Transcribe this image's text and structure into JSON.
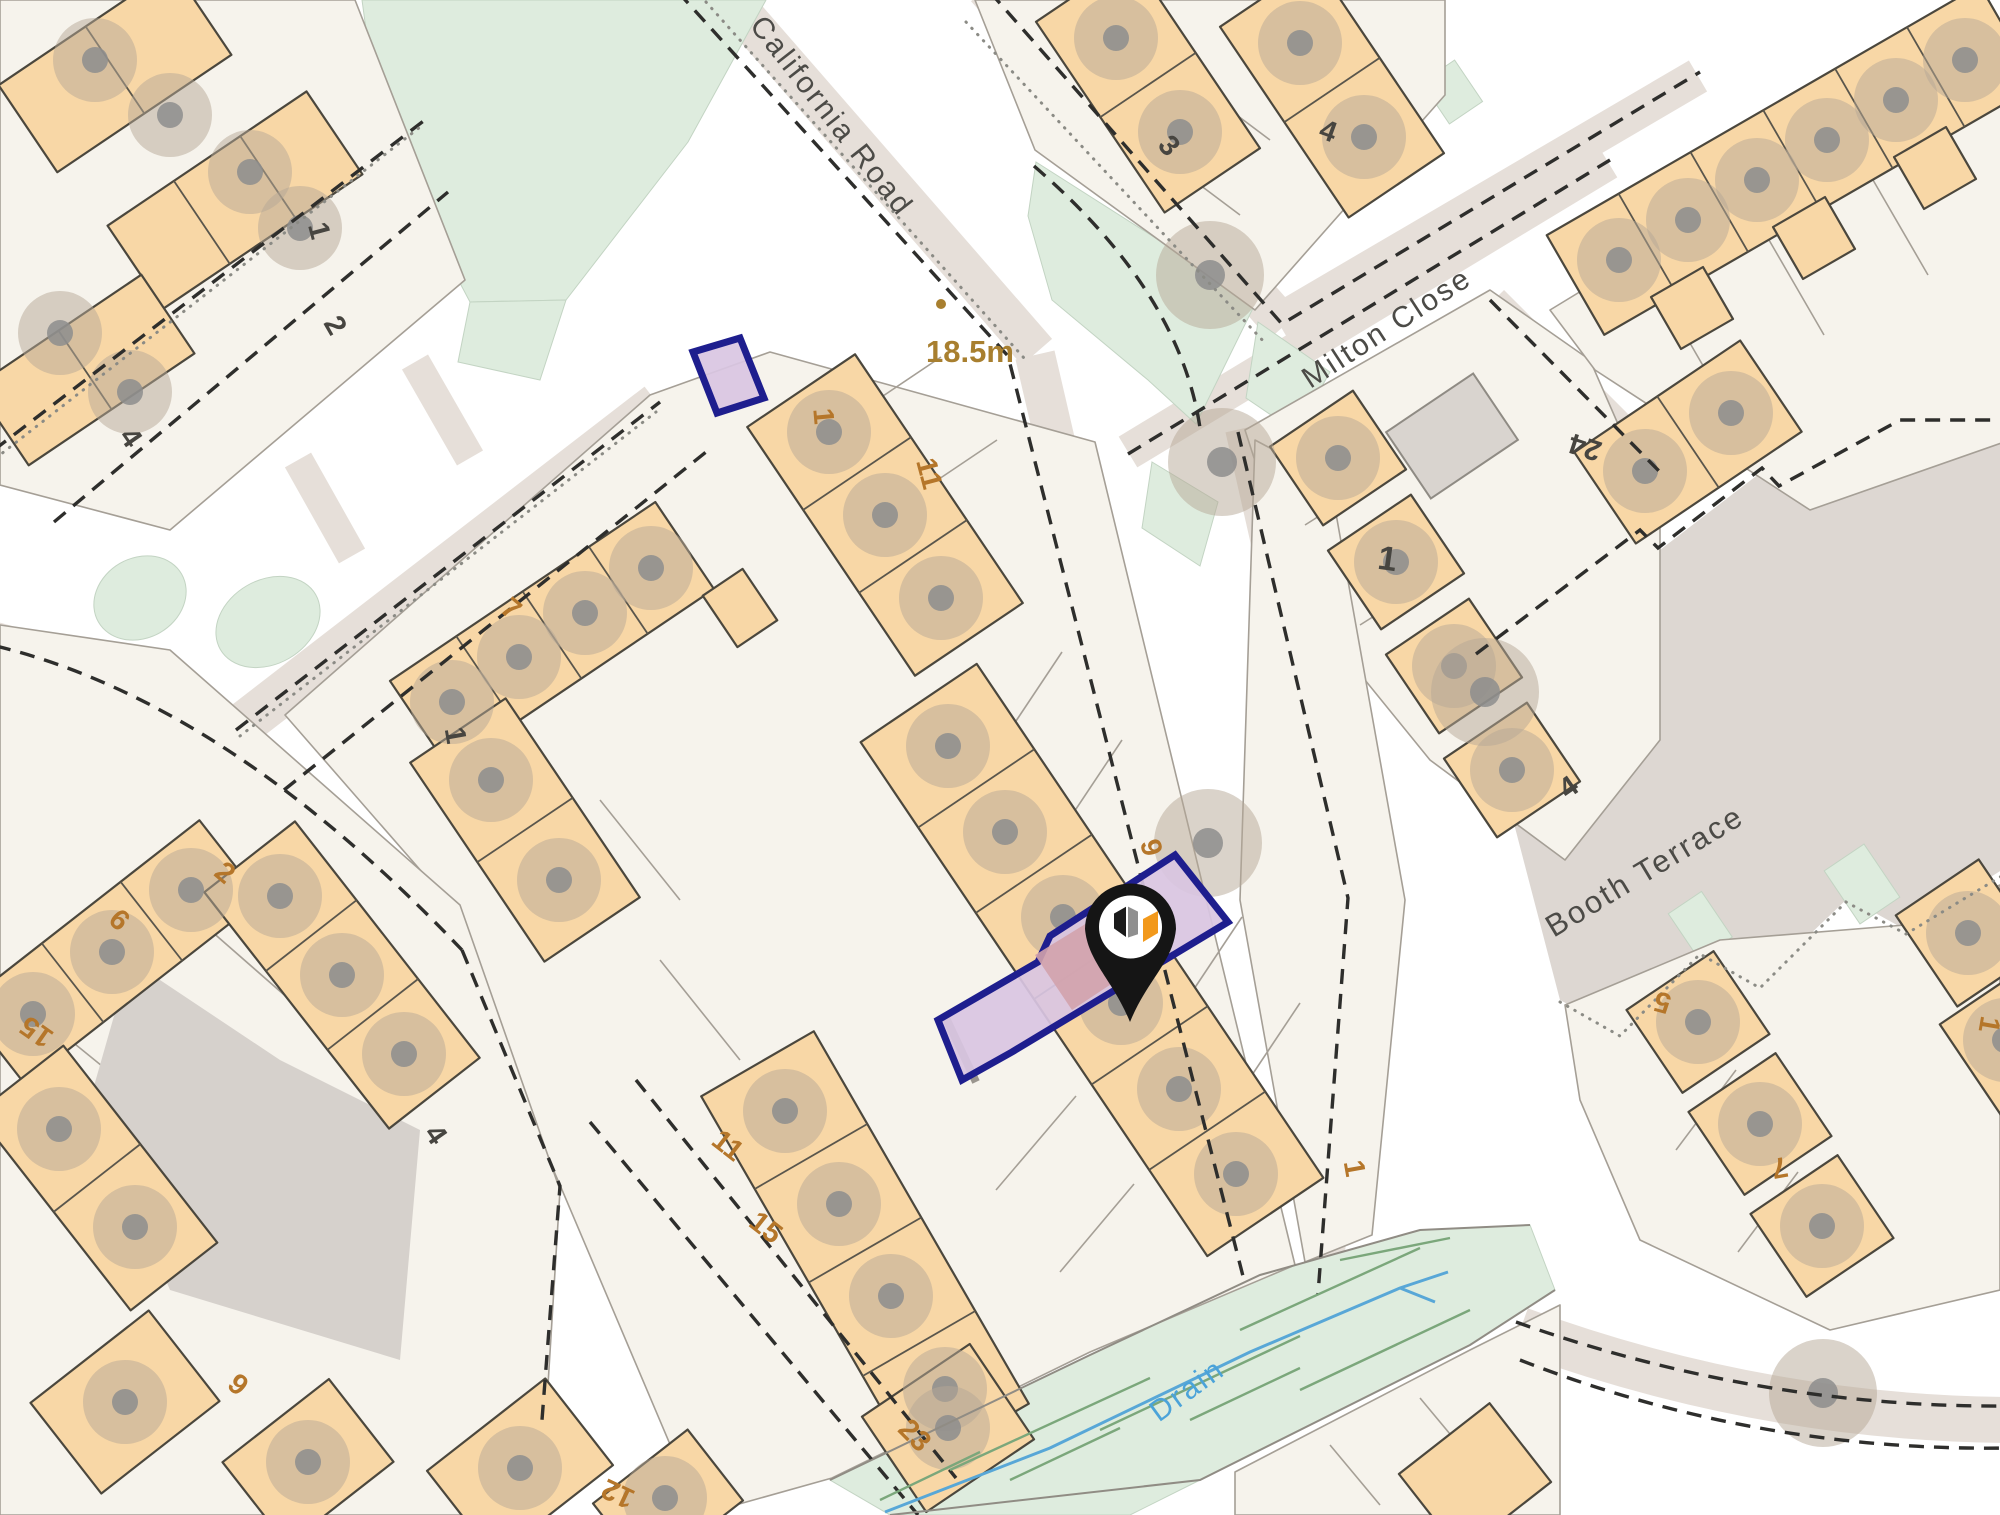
{
  "map": {
    "colors": {
      "building_fill": "#f8d7a6",
      "building_outline": "#4b473d",
      "parcel_fill": "#f6f3ec",
      "road_band": "#e6dfd9",
      "booth_terrace_surface": "#ddd7d2",
      "green_space": "#deecde",
      "boundary_dash": "#2e2e2c",
      "selection_fill": "#d9c5e2",
      "selection_stroke": "#1e1e8e",
      "building_in_selection": "#d2a2ac",
      "drain_blue": "#58a7d7",
      "house_number_orange": "#b5762a",
      "house_number_dark": "#474540",
      "street_label": "#4c4b47",
      "measurement": "#a87f2f",
      "pin_body": "#151515",
      "pin_accent_orange": "#f2991c"
    },
    "street_labels": [
      {
        "id": "california-road",
        "text": "California Road",
        "x": 824,
        "y": 122,
        "rot": 52,
        "size": 30,
        "tone": "road"
      },
      {
        "id": "milton-close",
        "text": "Milton Close",
        "x": 1392,
        "y": 336,
        "rot": -33,
        "size": 30,
        "tone": "road"
      },
      {
        "id": "booth-terrace",
        "text": "Booth Terrace",
        "x": 1650,
        "y": 880,
        "rot": -31,
        "size": 31,
        "tone": "road"
      },
      {
        "id": "drain",
        "text": "Drain",
        "x": 1193,
        "y": 1398,
        "rot": -36,
        "size": 30,
        "tone": "water"
      }
    ],
    "measurement": {
      "text": "18.5m",
      "x": 970,
      "y": 362,
      "dot": {
        "x": 941,
        "y": 304,
        "r": 5
      }
    },
    "marker": {
      "type": "property-pin",
      "x": 1130,
      "y": 935
    },
    "house_numbers": [
      {
        "text": "1",
        "x": 310,
        "y": 233,
        "rot": 75,
        "tone": "dark"
      },
      {
        "text": "2",
        "x": 327,
        "y": 330,
        "rot": 60,
        "tone": "dark"
      },
      {
        "text": "4",
        "x": 123,
        "y": 443,
        "rot": 55,
        "tone": "dark"
      },
      {
        "text": "3",
        "x": 1162,
        "y": 152,
        "rot": 48,
        "tone": "dark"
      },
      {
        "text": "4",
        "x": 1325,
        "y": 140,
        "rot": 20,
        "tone": "dark"
      },
      {
        "text": "24",
        "x": 1588,
        "y": 438,
        "rot": 198,
        "tone": "dark"
      },
      {
        "text": "1",
        "x": 1386,
        "y": 570,
        "rot": 8,
        "tone": "dark",
        "bold": true
      },
      {
        "text": "4",
        "x": 1574,
        "y": 795,
        "rot": -35,
        "tone": "dark"
      },
      {
        "text": "1",
        "x": 446,
        "y": 737,
        "rot": 80,
        "tone": "dark"
      },
      {
        "text": "4",
        "x": 428,
        "y": 1140,
        "rot": 55,
        "tone": "dark"
      },
      {
        "text": "7",
        "x": 505,
        "y": 616,
        "rot": 40,
        "tone": "orange"
      },
      {
        "text": "1",
        "x": 814,
        "y": 417,
        "rot": 85,
        "tone": "orange"
      },
      {
        "text": "11",
        "x": 920,
        "y": 476,
        "rot": 75,
        "tone": "orange"
      },
      {
        "text": "9",
        "x": 1142,
        "y": 850,
        "rot": 75,
        "tone": "orange"
      },
      {
        "text": "1",
        "x": 1345,
        "y": 1170,
        "rot": 80,
        "tone": "orange"
      },
      {
        "text": "11",
        "x": 722,
        "y": 1153,
        "rot": 38,
        "tone": "orange"
      },
      {
        "text": "15",
        "x": 760,
        "y": 1235,
        "rot": 38,
        "tone": "orange"
      },
      {
        "text": "23",
        "x": 908,
        "y": 1442,
        "rot": 45,
        "tone": "orange"
      },
      {
        "text": "2",
        "x": 219,
        "y": 880,
        "rot": 40,
        "tone": "orange"
      },
      {
        "text": "6",
        "x": 113,
        "y": 927,
        "rot": 42,
        "tone": "orange"
      },
      {
        "text": "15",
        "x": 42,
        "y": 1024,
        "rot": 215,
        "tone": "orange"
      },
      {
        "text": "9",
        "x": 232,
        "y": 1392,
        "rot": 40,
        "tone": "orange"
      },
      {
        "text": "12",
        "x": 622,
        "y": 1485,
        "rot": 205,
        "tone": "orange"
      },
      {
        "text": "5",
        "x": 1665,
        "y": 993,
        "rot": 195,
        "tone": "orange"
      },
      {
        "text": "7",
        "x": 1778,
        "y": 1158,
        "rot": 170,
        "tone": "orange"
      },
      {
        "text": "1",
        "x": 1980,
        "y": 1023,
        "rot": 100,
        "tone": "orange"
      }
    ],
    "trees": {
      "building": [
        [
          95,
          60
        ],
        [
          170,
          115
        ],
        [
          250,
          172
        ],
        [
          300,
          228
        ],
        [
          60,
          333
        ],
        [
          130,
          392
        ],
        [
          1116,
          38
        ],
        [
          1180,
          132
        ],
        [
          1300,
          43
        ],
        [
          1364,
          137
        ],
        [
          829,
          432
        ],
        [
          885,
          515
        ],
        [
          941,
          598
        ],
        [
          948,
          746
        ],
        [
          1005,
          832
        ],
        [
          1063,
          917
        ],
        [
          1121,
          1003
        ],
        [
          1179,
          1089
        ],
        [
          1236,
          1174
        ],
        [
          452,
          702
        ],
        [
          519,
          657
        ],
        [
          585,
          613
        ],
        [
          651,
          568
        ],
        [
          491,
          780
        ],
        [
          559,
          880
        ],
        [
          785,
          1111
        ],
        [
          839,
          1204
        ],
        [
          891,
          1296
        ],
        [
          945,
          1389
        ],
        [
          948,
          1428
        ],
        [
          1338,
          458
        ],
        [
          1396,
          562
        ],
        [
          1454,
          666
        ],
        [
          1512,
          770
        ],
        [
          1619,
          260
        ],
        [
          1688,
          220
        ],
        [
          1757,
          180
        ],
        [
          1827,
          140
        ],
        [
          1896,
          100
        ],
        [
          1965,
          60
        ],
        [
          1645,
          471
        ],
        [
          1731,
          413
        ],
        [
          1698,
          1022
        ],
        [
          1760,
          1124
        ],
        [
          1822,
          1226
        ],
        [
          1968,
          933
        ],
        [
          2005,
          1040
        ],
        [
          33,
          1014
        ],
        [
          112,
          952
        ],
        [
          191,
          890
        ],
        [
          59,
          1129
        ],
        [
          135,
          1227
        ],
        [
          280,
          896
        ],
        [
          342,
          975
        ],
        [
          404,
          1054
        ],
        [
          125,
          1402
        ],
        [
          308,
          1462
        ],
        [
          520,
          1468
        ],
        [
          665,
          1498
        ]
      ],
      "pavement": [
        [
          1210,
          275
        ],
        [
          1222,
          462
        ],
        [
          1208,
          843
        ],
        [
          1823,
          1393
        ],
        [
          1485,
          692
        ]
      ]
    }
  }
}
